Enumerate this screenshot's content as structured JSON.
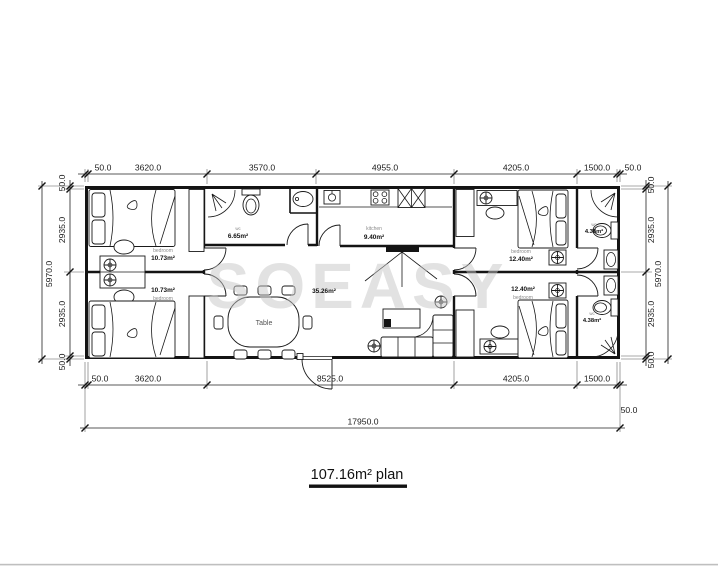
{
  "title": {
    "text": "107.16m² plan"
  },
  "watermark": "SOEASY",
  "dimensions": {
    "top": [
      "50.0",
      "3620.0",
      "3570.0",
      "4955.0",
      "4205.0",
      "1500.0",
      "50.0"
    ],
    "bottom": [
      "50.0",
      "3620.0",
      "8525.0",
      "4205.0",
      "1500.0"
    ],
    "bottom_right_end": "50.0",
    "total_width": "17950.0",
    "left": [
      "50.0",
      "2935.0",
      "2935.0",
      "50.0"
    ],
    "left_total": "5970.0",
    "right": [
      "50.0",
      "2935.0",
      "2935.0",
      "50.0"
    ],
    "right_total": "5970.0"
  },
  "rooms": {
    "bedroom_top_left": {
      "name": "bedroom",
      "area": "10.73m²"
    },
    "bedroom_bottom_left": {
      "name": "bedroom",
      "area": "10.73m²"
    },
    "wc_top_left": {
      "name": "wc",
      "area": "6.65m²"
    },
    "kitchen": {
      "name": "kitchen",
      "area": "9.40m²"
    },
    "living": {
      "area": "35.26m²"
    },
    "dining_table": {
      "label": "Table"
    },
    "bedroom_top_right": {
      "name": "bedroom",
      "area": "12.40m²"
    },
    "bedroom_bottom_right": {
      "name": "bedroom",
      "area": "12.40m²"
    },
    "wc_top_right": {
      "name": "wc",
      "area": "4.38m²"
    },
    "wc_bottom_right": {
      "name": "wc",
      "area": "4.38m²"
    }
  }
}
